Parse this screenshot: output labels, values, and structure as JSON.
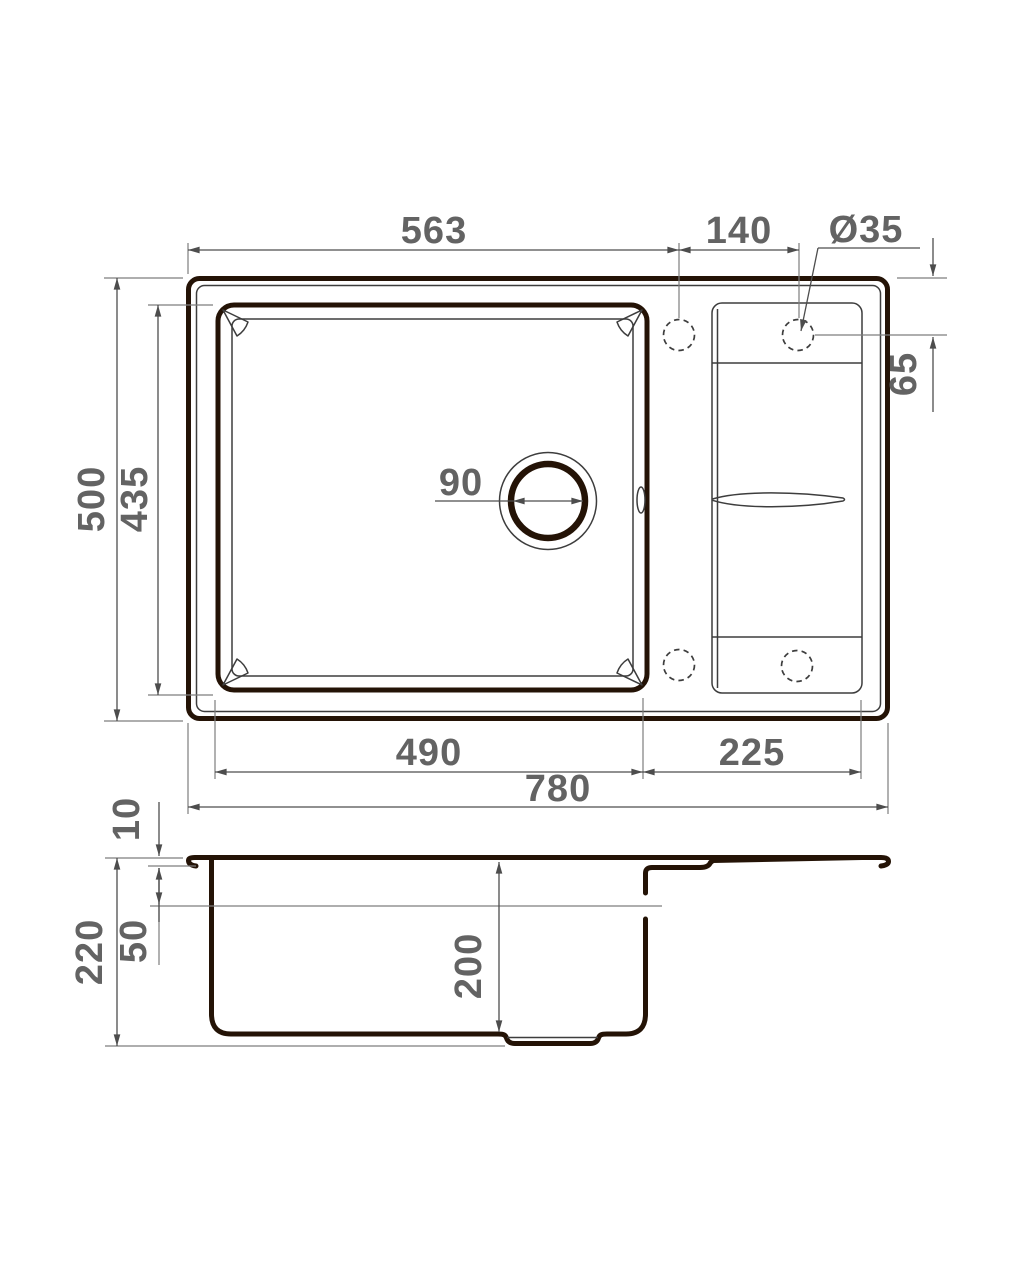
{
  "drawing": {
    "title": "Kitchen sink technical drawing",
    "views": [
      "top view (plan)",
      "side section"
    ],
    "units": "mm"
  },
  "dimensions": {
    "edge_to_hole": "563",
    "hole_pitch": "140",
    "faucet_hole_diameter": "Ø35",
    "hole_edge_offset": "65",
    "overall_depth": "500",
    "bowl_cutout_depth": "435",
    "drain_diameter": "90",
    "bowl_width": "490",
    "wing_width": "225",
    "overall_width": "780",
    "rim_height": "10",
    "overflow_offset": "50",
    "total_height": "220",
    "bowl_inner_depth": "200"
  },
  "colors": {
    "profile_line": "#241306",
    "object_line": "#3d3d3d",
    "dimension_line": "#4d4d4d",
    "extension_line": "#7d7d7d",
    "label_text": "#636363",
    "background": "#ffffff"
  }
}
